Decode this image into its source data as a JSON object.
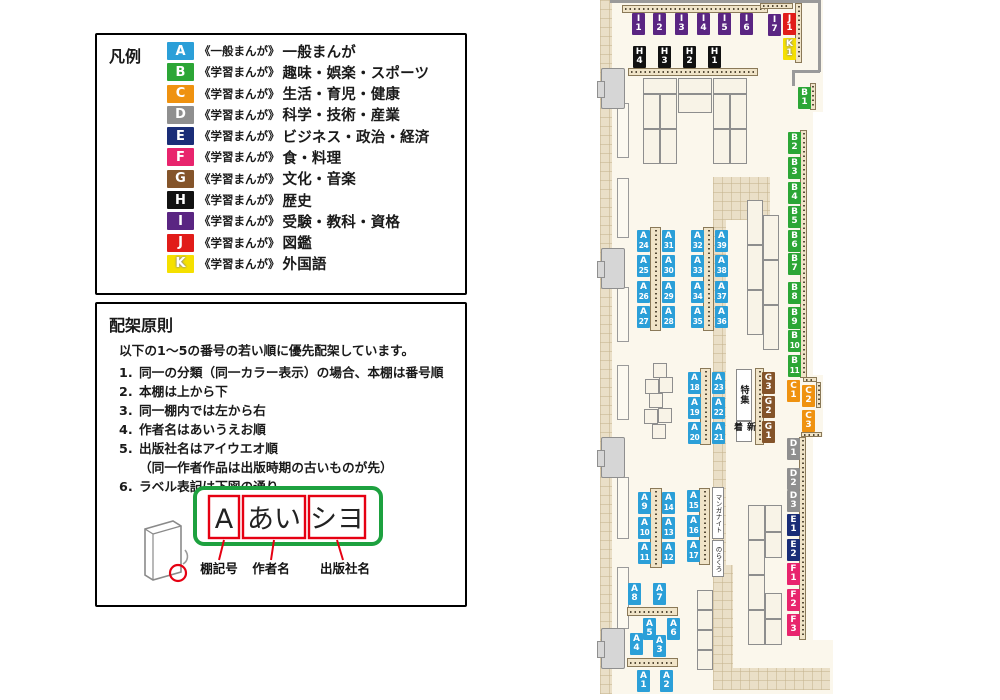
{
  "colors": {
    "A": "#2B9FD8",
    "B": "#2CA636",
    "C": "#EF9210",
    "D": "#8F8F8F",
    "E": "#1A2D77",
    "F": "#E8246D",
    "G": "#84542A",
    "H": "#111111",
    "I": "#5A2582",
    "J": "#E11C19",
    "K": "#F5E000"
  },
  "legend": {
    "title": "凡例",
    "items": [
      {
        "code": "A",
        "series": "《一般まんが》",
        "category": "一般まんが"
      },
      {
        "code": "B",
        "series": "《学習まんが》",
        "category": "趣味・娯楽・スポーツ"
      },
      {
        "code": "C",
        "series": "《学習まんが》",
        "category": "生活・育児・健康"
      },
      {
        "code": "D",
        "series": "《学習まんが》",
        "category": "科学・技術・産業"
      },
      {
        "code": "E",
        "series": "《学習まんが》",
        "category": "ビジネス・政治・経済"
      },
      {
        "code": "F",
        "series": "《学習まんが》",
        "category": "食・料理"
      },
      {
        "code": "G",
        "series": "《学習まんが》",
        "category": "文化・音楽"
      },
      {
        "code": "H",
        "series": "《学習まんが》",
        "category": "歴史"
      },
      {
        "code": "I",
        "series": "《学習まんが》",
        "category": "受験・教科・資格"
      },
      {
        "code": "J",
        "series": "《学習まんが》",
        "category": "図鑑"
      },
      {
        "code": "K",
        "series": "《学習まんが》",
        "category": "外国語"
      }
    ]
  },
  "principles": {
    "title": "配架原則",
    "intro": "以下の1〜5の番号の若い順に優先配架しています。",
    "items": [
      {
        "num": "1.",
        "text": "同一の分類（同一カラー表示）の場合、本棚は番号順"
      },
      {
        "num": "2.",
        "text": "本棚は上から下"
      },
      {
        "num": "3.",
        "text": "同一棚内では左から右"
      },
      {
        "num": "4.",
        "text": "作者名はあいうえお順"
      },
      {
        "num": "5.",
        "text": "出版社名はアイウエオ順",
        "sub": "（同一作者作品は出版時期の古いものが先）"
      },
      {
        "num": "6.",
        "text": "ラベル表記は下図の通り"
      }
    ],
    "label_example": {
      "shelf": "A",
      "author": "あい",
      "publisher": "シヨ",
      "captions": [
        "棚記号",
        "作者名",
        "出版社名"
      ]
    }
  },
  "map": {
    "areas": [
      {
        "text": "特集",
        "cls": "area-b",
        "x": 141,
        "y": 369,
        "w": 16,
        "h": 52
      },
      {
        "text": "新着",
        "cls": "area-b",
        "x": 141,
        "y": 421,
        "w": 16,
        "h": 21
      },
      {
        "text": "マンガナイト",
        "cls": "area-s",
        "x": 117,
        "y": 487,
        "w": 12,
        "h": 52
      },
      {
        "text": "のらくろ",
        "cls": "area-s",
        "x": 117,
        "y": 540,
        "w": 12,
        "h": 37
      }
    ],
    "labels": [
      {
        "t": "I",
        "n": "1",
        "x": 37,
        "y": 13
      },
      {
        "t": "I",
        "n": "2",
        "x": 58,
        "y": 13
      },
      {
        "t": "I",
        "n": "3",
        "x": 80,
        "y": 13
      },
      {
        "t": "I",
        "n": "4",
        "x": 102,
        "y": 13
      },
      {
        "t": "I",
        "n": "5",
        "x": 123,
        "y": 13
      },
      {
        "t": "I",
        "n": "6",
        "x": 145,
        "y": 13
      },
      {
        "t": "I",
        "n": "7",
        "x": 173,
        "y": 14
      },
      {
        "t": "J",
        "n": "1",
        "x": 188,
        "y": 13
      },
      {
        "t": "K",
        "n": "1",
        "x": 188,
        "y": 38
      },
      {
        "t": "H",
        "n": "4",
        "x": 38,
        "y": 46
      },
      {
        "t": "H",
        "n": "3",
        "x": 63,
        "y": 46
      },
      {
        "t": "H",
        "n": "2",
        "x": 88,
        "y": 46
      },
      {
        "t": "H",
        "n": "1",
        "x": 113,
        "y": 46
      },
      {
        "t": "B",
        "n": "1",
        "x": 203,
        "y": 87
      },
      {
        "t": "B",
        "n": "2",
        "x": 193,
        "y": 132
      },
      {
        "t": "B",
        "n": "3",
        "x": 193,
        "y": 157
      },
      {
        "t": "B",
        "n": "4",
        "x": 193,
        "y": 182
      },
      {
        "t": "B",
        "n": "5",
        "x": 193,
        "y": 206
      },
      {
        "t": "B",
        "n": "6",
        "x": 193,
        "y": 230
      },
      {
        "t": "B",
        "n": "7",
        "x": 193,
        "y": 253
      },
      {
        "t": "B",
        "n": "8",
        "x": 193,
        "y": 282
      },
      {
        "t": "B",
        "n": "9",
        "x": 193,
        "y": 307
      },
      {
        "t": "B",
        "n": "10",
        "x": 193,
        "y": 330
      },
      {
        "t": "B",
        "n": "11",
        "x": 193,
        "y": 355
      },
      {
        "t": "C",
        "n": "1",
        "x": 192,
        "y": 380
      },
      {
        "t": "C",
        "n": "2",
        "x": 207,
        "y": 385
      },
      {
        "t": "C",
        "n": "3",
        "x": 207,
        "y": 410
      },
      {
        "t": "D",
        "n": "1",
        "x": 192,
        "y": 438
      },
      {
        "t": "D",
        "n": "2",
        "x": 192,
        "y": 468
      },
      {
        "t": "D",
        "n": "3",
        "x": 192,
        "y": 490
      },
      {
        "t": "E",
        "n": "1",
        "x": 192,
        "y": 514
      },
      {
        "t": "E",
        "n": "2",
        "x": 192,
        "y": 539
      },
      {
        "t": "F",
        "n": "1",
        "x": 192,
        "y": 563
      },
      {
        "t": "F",
        "n": "2",
        "x": 192,
        "y": 589
      },
      {
        "t": "F",
        "n": "3",
        "x": 192,
        "y": 614
      },
      {
        "t": "G",
        "n": "3",
        "x": 167,
        "y": 372
      },
      {
        "t": "G",
        "n": "2",
        "x": 167,
        "y": 396
      },
      {
        "t": "G",
        "n": "1",
        "x": 167,
        "y": 421
      },
      {
        "t": "A",
        "n": "24",
        "x": 42,
        "y": 230
      },
      {
        "t": "A",
        "n": "25",
        "x": 42,
        "y": 255
      },
      {
        "t": "A",
        "n": "26",
        "x": 42,
        "y": 281
      },
      {
        "t": "A",
        "n": "27",
        "x": 42,
        "y": 306
      },
      {
        "t": "A",
        "n": "31",
        "x": 67,
        "y": 230
      },
      {
        "t": "A",
        "n": "30",
        "x": 67,
        "y": 255
      },
      {
        "t": "A",
        "n": "29",
        "x": 67,
        "y": 281
      },
      {
        "t": "A",
        "n": "28",
        "x": 67,
        "y": 306
      },
      {
        "t": "A",
        "n": "32",
        "x": 96,
        "y": 230
      },
      {
        "t": "A",
        "n": "33",
        "x": 96,
        "y": 255
      },
      {
        "t": "A",
        "n": "34",
        "x": 96,
        "y": 281
      },
      {
        "t": "A",
        "n": "35",
        "x": 96,
        "y": 306
      },
      {
        "t": "A",
        "n": "39",
        "x": 120,
        "y": 230
      },
      {
        "t": "A",
        "n": "38",
        "x": 120,
        "y": 255
      },
      {
        "t": "A",
        "n": "37",
        "x": 120,
        "y": 281
      },
      {
        "t": "A",
        "n": "36",
        "x": 120,
        "y": 306
      },
      {
        "t": "A",
        "n": "18",
        "x": 93,
        "y": 372
      },
      {
        "t": "A",
        "n": "19",
        "x": 93,
        "y": 397
      },
      {
        "t": "A",
        "n": "20",
        "x": 93,
        "y": 422
      },
      {
        "t": "A",
        "n": "23",
        "x": 117,
        "y": 372
      },
      {
        "t": "A",
        "n": "22",
        "x": 117,
        "y": 397
      },
      {
        "t": "A",
        "n": "21",
        "x": 117,
        "y": 422
      },
      {
        "t": "A",
        "n": "15",
        "x": 92,
        "y": 490
      },
      {
        "t": "A",
        "n": "16",
        "x": 92,
        "y": 515
      },
      {
        "t": "A",
        "n": "17",
        "x": 92,
        "y": 540
      },
      {
        "t": "A",
        "n": "9",
        "x": 43,
        "y": 492
      },
      {
        "t": "A",
        "n": "10",
        "x": 43,
        "y": 517
      },
      {
        "t": "A",
        "n": "11",
        "x": 43,
        "y": 542
      },
      {
        "t": "A",
        "n": "14",
        "x": 67,
        "y": 492
      },
      {
        "t": "A",
        "n": "13",
        "x": 67,
        "y": 517
      },
      {
        "t": "A",
        "n": "12",
        "x": 67,
        "y": 542
      },
      {
        "t": "A",
        "n": "8",
        "x": 33,
        "y": 583
      },
      {
        "t": "A",
        "n": "7",
        "x": 58,
        "y": 583
      },
      {
        "t": "A",
        "n": "5",
        "x": 48,
        "y": 618
      },
      {
        "t": "A",
        "n": "6",
        "x": 72,
        "y": 618
      },
      {
        "t": "A",
        "n": "4",
        "x": 35,
        "y": 633
      },
      {
        "t": "A",
        "n": "3",
        "x": 58,
        "y": 635
      },
      {
        "t": "A",
        "n": "1",
        "x": 42,
        "y": 670
      },
      {
        "t": "A",
        "n": "2",
        "x": 65,
        "y": 670
      }
    ]
  }
}
